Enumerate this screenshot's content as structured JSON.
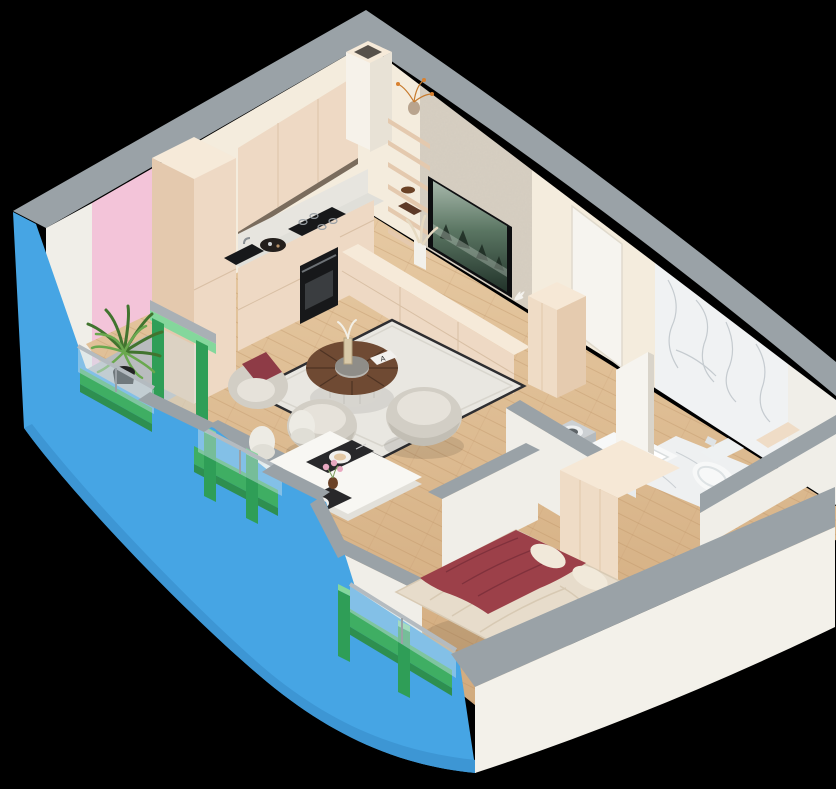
{
  "scene": {
    "card_letter": "A"
  },
  "colors": {
    "background": "#000000",
    "wall_top": "#9aa2a7",
    "wall_top_light": "#a9b0b5",
    "outer_blue": "#46a5e4",
    "outer_white": "#f3f1ea",
    "inner_white": "#f0eee8",
    "pink_wall": "#f3c4d9",
    "cream_wall": "#f4ecdd",
    "stone_wall": "#d7cfc2",
    "marble_base": "#f0f2f3",
    "marble_floor": "#eef0f1",
    "wood_light": "#e3c49c",
    "wood_dark": "#d2ab7e",
    "concrete": "#b9bcbe",
    "green_frame": "#2f9e57",
    "green_frame_light": "#84d79c",
    "green_frame_dark": "#1f7f43",
    "green_slab": "#3fae63",
    "green_slab_dark": "#2e8f50",
    "glass": "#cfe2ec",
    "handrail": "#b4bbc0",
    "cab_front": "#eed9c4",
    "cab_top": "#f6ead9",
    "cab_side": "#e4c9ae",
    "cab_shadow": "#7a6c5d",
    "counter": "#e0dfd9",
    "backsplash": "#e7e5df",
    "appliance_dark": "#17181a",
    "appliance_mid": "#3a3d40",
    "rug": "#e9e7e1",
    "rug_border": "#2e2e31",
    "table_wood": "#6f4a33",
    "table_wood_dark": "#4e3323",
    "table_base": "#d7d5cf",
    "chair_shell": "#d2cec5",
    "chair_cushion": "#e6e2da",
    "chair_shade": "#c2beb4",
    "sofa_accent": "#8e3b46",
    "dining_table": "#f8f7f3",
    "dining_table_side": "#e2e0da",
    "dining_chair": "#edebe4",
    "placemat": "#28282a",
    "plate": "#f2f1ee",
    "flower_pink": "#e8a8c0",
    "vase_brown": "#6b4226",
    "duvet": "#e7dccb",
    "duvet_light": "#f1e9da",
    "blanket": "#9c4049",
    "blanket_dark": "#7e303b",
    "wardrobe_front": "#efdcc6",
    "wardrobe_top": "#f6e8d6",
    "wardrobe_side": "#e5cbaf",
    "fixture_white": "#f7f8f8",
    "fixture_shade": "#e8ebec",
    "washer_silver": "#ccd0d3",
    "washer_front": "#9aa0a4",
    "washer_side": "#b4babe",
    "washer_drum": "#5d6367",
    "door_white": "#f6f4ef",
    "door_edge": "#d9d4ca",
    "tv_bezel": "#0e0f11",
    "plant_dark": "#41742f",
    "plant_light": "#6aa84f",
    "pot_black": "#232323",
    "pampas": "#e6dac2",
    "vase_orange": "#d9812f",
    "decor_brown": "#6b4226"
  }
}
